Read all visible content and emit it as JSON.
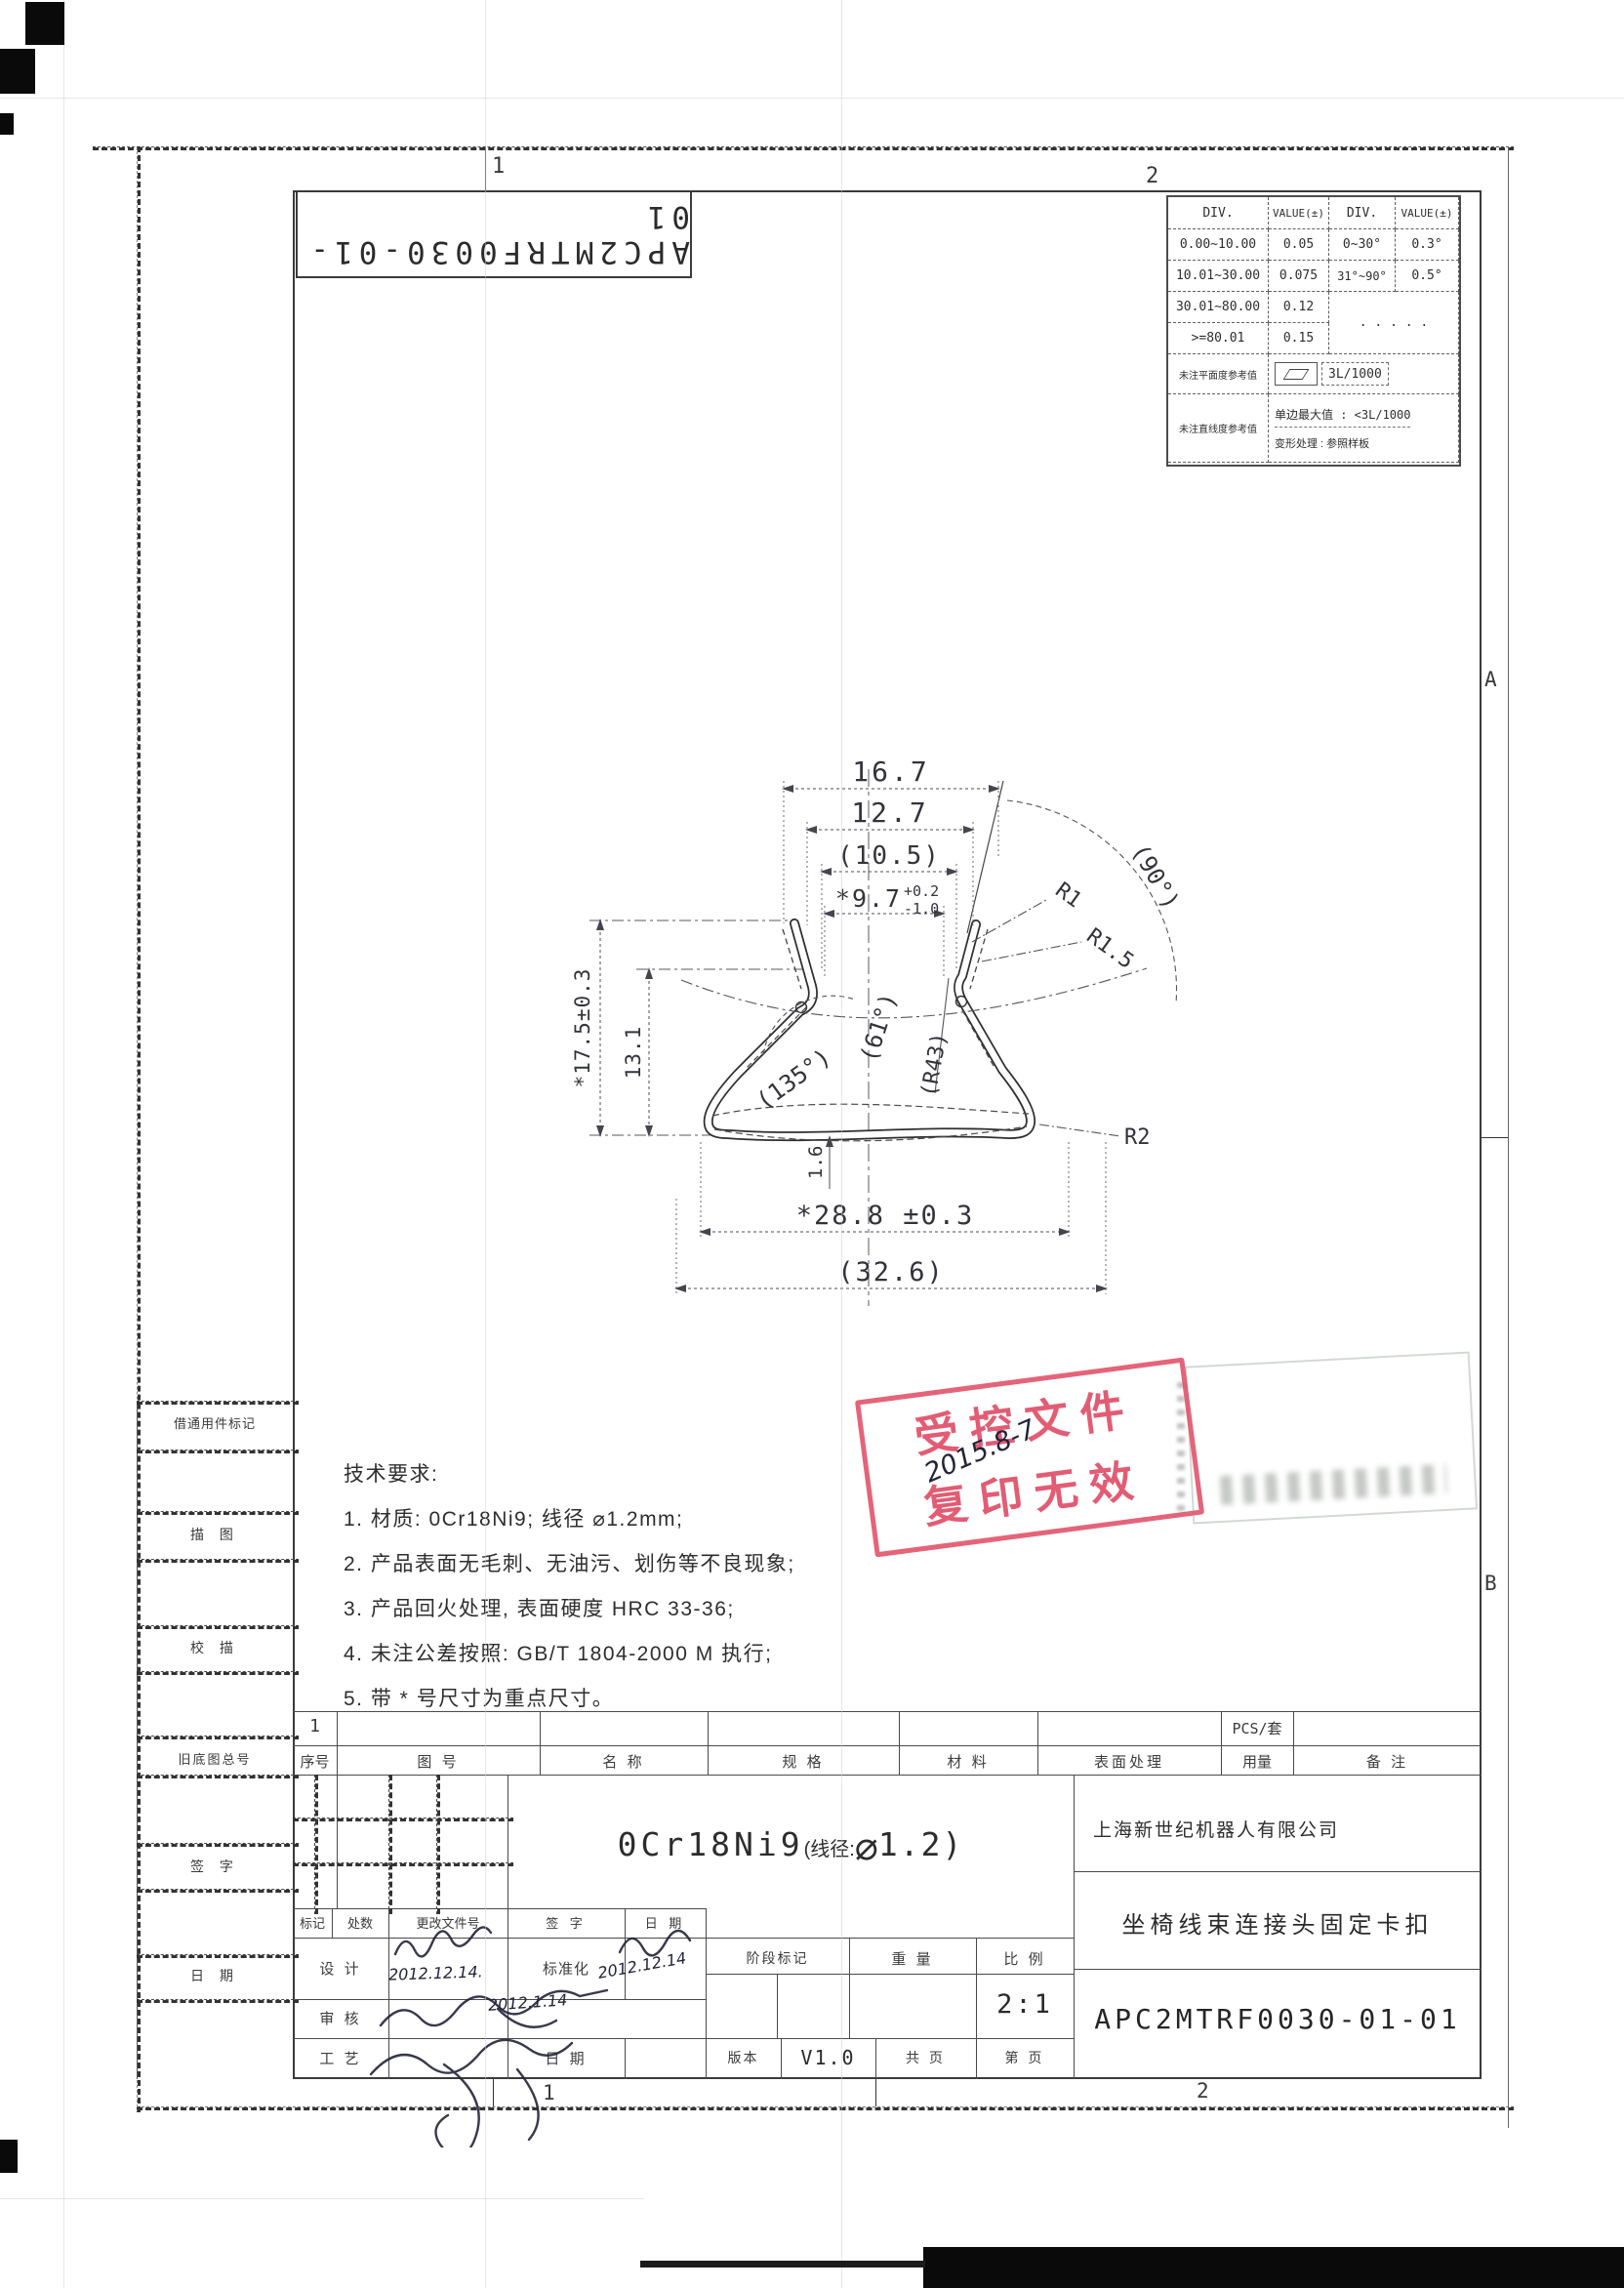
{
  "page": {
    "zone_labels": {
      "top_left": "1",
      "top_right": "2",
      "right_upper": "A",
      "right_lower": "B",
      "bottom_left": "1",
      "bottom_right": "2"
    },
    "doc_number_box": "APC2MTRF0030-01-01"
  },
  "tolerance_table": {
    "h0": "DIV.",
    "h1": "VALUE(±)",
    "h2": "DIV.",
    "h3": "VALUE(±)",
    "rows": [
      {
        "div": "0.00~10.00",
        "val": "0.05",
        "adiv": "0~30°",
        "aval": "0.3°"
      },
      {
        "div": "10.01~30.00",
        "val": "0.075",
        "adiv": "31°~90°",
        "aval": "0.5°"
      },
      {
        "div": "30.01~80.00",
        "val": "0.12"
      },
      {
        "div": ">=80.01",
        "val": "0.15"
      }
    ],
    "angle_merged": ". . . . .",
    "flatness_label": "未注平面度参考值",
    "flatness_value": "3L/1000",
    "straightness_label": "未注直线度参考值",
    "straight_line1": "单边最大值 : <3L/1000",
    "straight_line2": "变形处理 : 参照样板"
  },
  "drawing": {
    "dim_16_7": "16.7",
    "dim_12_7": "12.7",
    "dim_10_5": "(10.5)",
    "dim_9_7": "*9.7",
    "tol_up": "+0.2",
    "tol_dn": "-1.0",
    "r1": "R1",
    "r1_5": "R1.5",
    "angle_90": "(90°)",
    "dim_17_5": "*17.5±0.3",
    "dim_13": "13.1",
    "angle_135": "(135°)",
    "angle_61": "(61°)",
    "arc_r43": "(R43)",
    "r2": "R2",
    "dim_1_6": "1.6",
    "dim_28_8": "*28.8 ±0.3",
    "dim_32_6": "(32.6)"
  },
  "tech": {
    "title": "技术要求:",
    "items": [
      "1. 材质: 0Cr18Ni9; 线径 ⌀1.2mm;",
      "2. 产品表面无毛刺、无油污、划伤等不良现象;",
      "3. 产品回火处理, 表面硬度 HRC 33-36;",
      "4. 未注公差按照: GB/T 1804-2000 M 执行;",
      "5. 带 * 号尺寸为重点尺寸。"
    ]
  },
  "stamp": {
    "line1": "受控文件",
    "line2": "复印无效",
    "date": "2015.8-7"
  },
  "left_margin": {
    "item0": "借通用件标记",
    "item1": "描 图",
    "item2": "校 描",
    "item3": "旧底图总号",
    "item4": "签 字",
    "item5": "日 期"
  },
  "title_block": {
    "row1_cell": "1",
    "pcs": "PCS/套",
    "headers": [
      "序号",
      "图 号",
      "名 称",
      "规 格",
      "材 料",
      "表面处理",
      "用量",
      "备 注"
    ],
    "material_prefix": "0Cr18Ni9",
    "material_mid": "(线径:",
    "material_dia": "⌀",
    "material_suffix": "1.2)",
    "company": "上海新世纪机器人有限公司",
    "part_name": "坐椅线束连接头固定卡扣",
    "drawing_no": "APC2MTRF0030-01-01",
    "rev0": "标记",
    "rev1": "处数",
    "rev2": "更改文件号",
    "rev3": "签 字",
    "rev4": "日 期",
    "role_design": "设 计",
    "role_std": "标准化",
    "role_audit": "审 核",
    "role_process": "工 艺",
    "role_date": "日 期",
    "stage_label": "阶段标记",
    "weight_label": "重 量",
    "scale_label": "比 例",
    "scale_value": "2:1",
    "version_label": "版本",
    "version_value": "V1.0",
    "pages_total": "共 页",
    "page_no": "第 页",
    "hw_date_design": "2012.12.14.",
    "hw_date_std": "2012.12.14",
    "hw_date_audit": "2012.1.14"
  }
}
